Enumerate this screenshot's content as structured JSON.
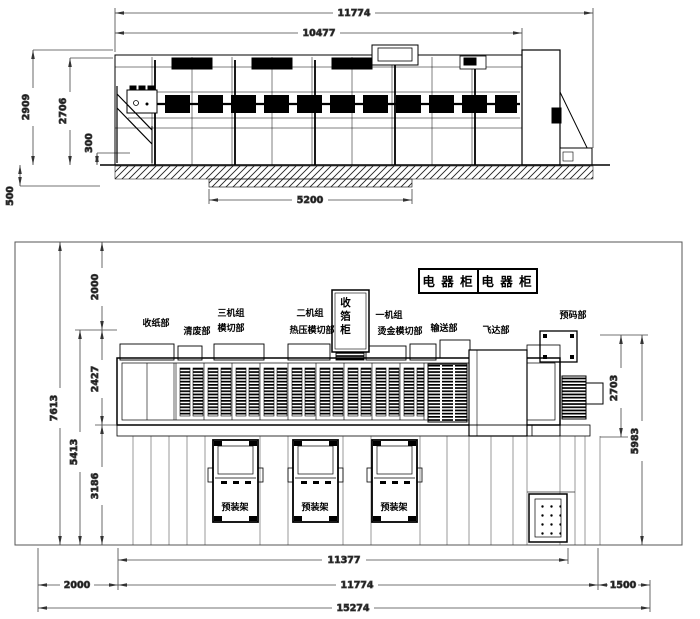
{
  "colors": {
    "background": "#ffffff",
    "machine_line": "#000000",
    "dim_line": "#444444"
  },
  "elevation_view": {
    "dim_total_length": "11774",
    "dim_body_length": "10477",
    "dim_overall_height": "2909",
    "dim_machine_height": "2706",
    "dim_platform_height": "300",
    "dim_foundation_depth": "500",
    "dim_pit_length": "5200"
  },
  "plan_view": {
    "electric_cabinet_left": "电 器 柜",
    "electric_cabinet_right": "电 器 柜",
    "labels": {
      "paper_delivery": "收纸部",
      "waste_cleaning": "清废部",
      "unit3_line1": "三机组",
      "unit3_line2": "模切部",
      "unit2_line1": "二机组",
      "unit2_line2": "热压模切部",
      "foil_cabinet": "收箔柜",
      "unit1_line1": "一机组",
      "unit1_line2": "烫金模切部",
      "conveyor": "输送部",
      "feeder": "飞达部",
      "prestack": "预码部"
    },
    "racks": [
      "预装架",
      "预装架",
      "预装架"
    ],
    "dims": {
      "left_total": "7613",
      "left_inner": "5413",
      "left_gap": "2000",
      "band_width": "2427",
      "lower_width": "3186",
      "right_inner": "2703",
      "right_outer": "5983",
      "machine_length": "11377",
      "bottom_left_gap": "2000",
      "bottom_machine": "11774",
      "bottom_right_gap": "1500",
      "bottom_total": "15274"
    }
  }
}
